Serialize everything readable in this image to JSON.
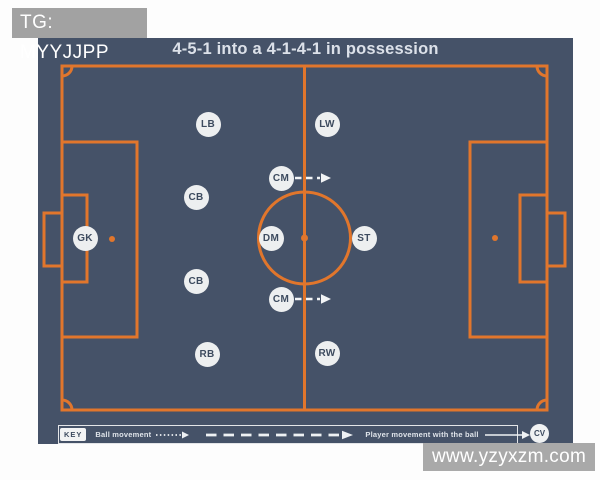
{
  "header": {
    "tag_label": "TG: MYYJJPP",
    "title": "4-5-1 into a 4-1-4-1 in possession"
  },
  "pitch": {
    "players": [
      {
        "label": "GK",
        "x": 85,
        "y": 238,
        "arrow": false
      },
      {
        "label": "LB",
        "x": 208,
        "y": 124,
        "arrow": false
      },
      {
        "label": "CB",
        "x": 196,
        "y": 197,
        "arrow": false
      },
      {
        "label": "CB",
        "x": 196,
        "y": 281,
        "arrow": false
      },
      {
        "label": "RB",
        "x": 207,
        "y": 354,
        "arrow": false
      },
      {
        "label": "LW",
        "x": 327,
        "y": 124,
        "arrow": false
      },
      {
        "label": "CM",
        "x": 281,
        "y": 178,
        "arrow": true
      },
      {
        "label": "DM",
        "x": 271,
        "y": 238,
        "arrow": false
      },
      {
        "label": "CM",
        "x": 281,
        "y": 299,
        "arrow": true
      },
      {
        "label": "RW",
        "x": 327,
        "y": 353,
        "arrow": false
      },
      {
        "label": "ST",
        "x": 364,
        "y": 238,
        "arrow": false
      }
    ]
  },
  "key": {
    "key_label": "KEY",
    "ball_movement_label": "Ball movement",
    "player_movement_label": "Player movement with the ball",
    "cv_badge": "CV"
  },
  "watermark": "www.yzyxzm.com",
  "colors": {
    "pitch_slate": "#455268",
    "line_orange": "#e1762c",
    "badge_fill": "#edeff0",
    "badge_text": "#3d4b5f",
    "label_gray": "#a2a2a2",
    "watermark_gray": "#a9a9a9",
    "arrow_white": "#f2f4f6"
  }
}
